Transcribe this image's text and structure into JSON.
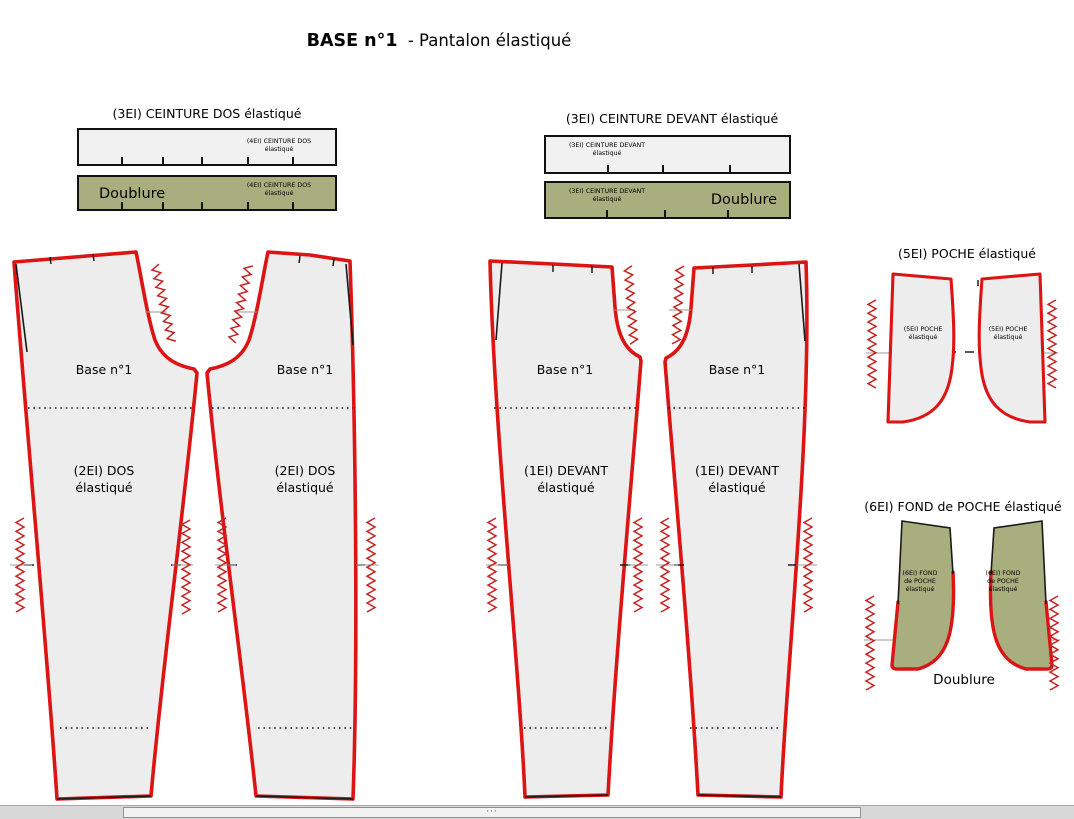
{
  "title": {
    "name": "BASE n°1",
    "subtitle": "- Pantalon élastiqué"
  },
  "ceinture_dos": {
    "heading": "(3EI) CEINTURE DOS élastiqué",
    "label_line1": "(4EI) CEINTURE DOS",
    "label_line2": "élastiqué",
    "doublure_label": "Doublure"
  },
  "ceinture_devant": {
    "heading": "(3EI) CEINTURE DEVANT élastiqué",
    "label_line1": "(3EI) CEINTURE DEVANT",
    "label_line2": "élastiqué",
    "doublure_label": "Doublure"
  },
  "dos": {
    "base_label": "Base n°1",
    "label_line1": "(2EI) DOS",
    "label_line2": "élastiqué"
  },
  "devant": {
    "base_label": "Base n°1",
    "label_line1": "(1EI) DEVANT",
    "label_line2": "élastiqué"
  },
  "poche": {
    "heading": "(5EI) POCHE élastiqué",
    "label_line1": "(5EI) POCHE",
    "label_line2": "élastiqué"
  },
  "fond_poche": {
    "heading": "(6EI) FOND de POCHE élastiqué",
    "label_line1": "(6EI) FOND",
    "label_line2": "de POCHE",
    "label_line3": "élastiqué",
    "doublure_label": "Doublure"
  },
  "scrollbar": {
    "grip": "···"
  },
  "colors": {
    "outline_red": "#dd1414",
    "lining_olive": "#a9ae7e",
    "piece_fill": "#ededed",
    "bar_fill": "#f1f1f1"
  }
}
